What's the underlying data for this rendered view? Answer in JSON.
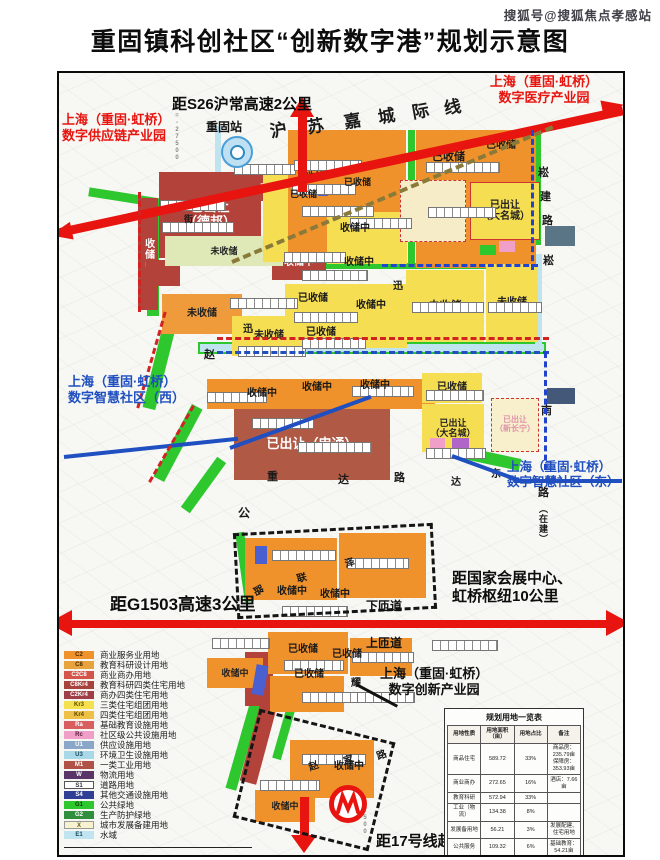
{
  "watermark": "搜狐号@搜狐焦点孝感站",
  "title": "重固镇科创社区“创新数字港”规划示意图",
  "colors": {
    "accent_red": "#e8140f",
    "label_blue": "#1f4fc0",
    "label_red": "#e8140f"
  },
  "callouts": {
    "s26": "距S26沪常高速2公里",
    "medical_1": "上海（重固·虹桥）",
    "medical_2": "数字医疗产业园",
    "supply_1": "上海（重固·虹桥）",
    "supply_2": "数字供应链产业园",
    "west_1": "上海（重固·虹桥）",
    "west_2": "数字智慧社区（西）",
    "east_1": "上海（重固·虹桥）",
    "east_2": "数字智慧社区（东）",
    "innovation_1": "上海（重固·虹桥）",
    "innovation_2": "数字创新产业园",
    "g1503": "距G1503高速3公里",
    "expo_1": "距国家会展中心、",
    "expo_2": "虹桥枢纽10公里",
    "down_ramp": "下匝道",
    "up_ramp": "上匝道",
    "metro17": "距17号线赵巷站1公里",
    "station": "重固站"
  },
  "legend": {
    "items": [
      {
        "code": "C2",
        "label": "商业服务业用地",
        "color": "#f0922b",
        "fg": "#4a2c00"
      },
      {
        "code": "C8",
        "label": "教育科研设计用地",
        "color": "#e8a33c",
        "fg": "#4a2c00"
      },
      {
        "code": "C2C8",
        "label": "商业商办用地",
        "color": "#d4554a",
        "fg": "#ffffff"
      },
      {
        "code": "C8Kr4",
        "label": "教育科研四类住宅用地",
        "color": "#a8423c",
        "fg": "#ffffff"
      },
      {
        "code": "C2Kr4",
        "label": "商办四类住宅用地",
        "color": "#9e3f48",
        "fg": "#ffffff"
      },
      {
        "code": "Kr3",
        "label": "三类住宅组团用地",
        "color": "#f5e04e",
        "fg": "#5a4a00"
      },
      {
        "code": "Kr4",
        "label": "四类住宅组团用地",
        "color": "#eec045",
        "fg": "#5a4a00"
      },
      {
        "code": "Ra",
        "label": "基础教育设施用地",
        "color": "#d95f5f",
        "fg": "#ffffff"
      },
      {
        "code": "Rc",
        "label": "社区级公共设施用地",
        "color": "#f0a0c8",
        "fg": "#5a1a3a"
      },
      {
        "code": "U1",
        "label": "供应设施用地",
        "color": "#8aa6c8",
        "fg": "#ffffff"
      },
      {
        "code": "U3",
        "label": "环境卫生设施用地",
        "color": "#a9d9e8",
        "fg": "#1a4a5a"
      },
      {
        "code": "M1",
        "label": "一类工业用地",
        "color": "#b05248",
        "fg": "#ffffff"
      },
      {
        "code": "W",
        "label": "物流用地",
        "color": "#5a3668",
        "fg": "#ffffff"
      },
      {
        "code": "S1",
        "label": "道路用地",
        "color": "#ffffff",
        "fg": "#333333",
        "border": "1px solid #555"
      },
      {
        "code": "S4",
        "label": "其他交通设施用地",
        "color": "#2f3f96",
        "fg": "#ffffff"
      },
      {
        "code": "G1",
        "label": "公共绿地",
        "color": "#2ec82e",
        "fg": "#063a06"
      },
      {
        "code": "G2",
        "label": "生产防护绿地",
        "color": "#2f8f3c",
        "fg": "#ffffff"
      },
      {
        "code": "X",
        "label": "城市发展备建用地",
        "color": "#f7f2cf",
        "fg": "#6a5a20",
        "border": "1px solid #999"
      },
      {
        "code": "E1",
        "label": "水域",
        "color": "#c0e4f0",
        "fg": "#1a4a5a"
      }
    ]
  },
  "table": {
    "title": "规划用地一览表",
    "headers": [
      "用地性质",
      "用地面积（亩）",
      "用地占比",
      "备注"
    ],
    "rows": [
      [
        "商品住宅",
        "589.72",
        "33%",
        "商品房：235.79亩\n保障房：353.93亩"
      ],
      [
        "商业商办",
        "272.65",
        "16%",
        "酒店：7.66亩"
      ],
      [
        "教育科研",
        "572.94",
        "33%",
        ""
      ],
      [
        "工业（物流）",
        "134.38",
        "8%",
        ""
      ],
      [
        "发展备用地",
        "56.21",
        "3%",
        "发展配建、住宅用地"
      ],
      [
        "公共服务",
        "109.32",
        "6%",
        "基础教育：54.21亩"
      ],
      [
        "合计",
        "1724.6",
        "100%",
        ""
      ]
    ]
  },
  "map": {
    "parcels": [
      {
        "x": 86,
        "y": 197,
        "w": 150,
        "h": 9,
        "bg": "#2ec82e",
        "rot": 9
      },
      {
        "x": 145,
        "y": 206,
        "w": 12,
        "h": 108,
        "bg": "#2ec82e"
      },
      {
        "x": 152,
        "y": 312,
        "w": 13,
        "h": 96,
        "bg": "#2ec82e",
        "rot": 14
      },
      {
        "x": 170,
        "y": 400,
        "w": 12,
        "h": 82,
        "bg": "#2ec82e",
        "rot": 28
      },
      {
        "x": 196,
        "y": 452,
        "w": 11,
        "h": 62,
        "bg": "#2ec82e",
        "rot": 36
      },
      {
        "x": 406,
        "y": 128,
        "w": 7,
        "h": 138,
        "bg": "#2ec82e"
      },
      {
        "x": 287,
        "y": 261,
        "w": 250,
        "h": 6,
        "bg": "#2ec82e"
      },
      {
        "x": 534,
        "y": 128,
        "w": 5,
        "h": 115,
        "bg": "#2ec82e"
      },
      {
        "x": 424,
        "y": 447,
        "w": 95,
        "h": 12,
        "bg": "#2ec82e",
        "rot": 12
      },
      {
        "x": 236,
        "y": 697,
        "w": 11,
        "h": 92,
        "bg": "#2ec82e",
        "rot": 16
      },
      {
        "x": 278,
        "y": 700,
        "w": 9,
        "h": 58,
        "bg": "#2ec82e",
        "rot": 16
      },
      {
        "x": 238,
        "y": 530,
        "w": 9,
        "h": 70,
        "bg": "#2ec82e",
        "rot": -8
      },
      {
        "x": 196,
        "y": 340,
        "w": 348,
        "h": 12,
        "bg": "#bfe3ef",
        "bd": "2px solid #2ec82e",
        "n": "river"
      },
      {
        "x": 533,
        "y": 252,
        "w": 7,
        "h": 92,
        "bg": "#bfe3ef",
        "n": "canal"
      },
      {
        "x": 213,
        "y": 124,
        "w": 6,
        "h": 48,
        "bg": "#bfe3ef",
        "n": "canal"
      },
      {
        "x": 157,
        "y": 170,
        "w": 102,
        "h": 86,
        "bg": "#b2423a",
        "t": "已出让",
        "t2": "（德邦）",
        "fg": "#fff",
        "fs": 13
      },
      {
        "x": 136,
        "y": 196,
        "w": 20,
        "h": 112,
        "bg": "#b2423a",
        "t": "收储中",
        "fg": "#fff",
        "fs": 10,
        "vert": 1
      },
      {
        "x": 250,
        "y": 173,
        "w": 40,
        "h": 26,
        "bg": "#b2423a",
        "t": "已收储",
        "fg": "#fff",
        "fs": 8
      },
      {
        "x": 270,
        "y": 244,
        "w": 54,
        "h": 34,
        "bg": "#b2423a",
        "t": "收储中",
        "fg": "#fff",
        "fs": 10
      },
      {
        "x": 144,
        "y": 258,
        "w": 34,
        "h": 26,
        "bg": "#b2423a"
      },
      {
        "x": 232,
        "y": 406,
        "w": 156,
        "h": 72,
        "bg": "#b05a45",
        "t": "已出让（申通）",
        "fg": "#fff",
        "fs": 13
      },
      {
        "x": 243,
        "y": 650,
        "w": 28,
        "h": 54,
        "bg": "#b2423a"
      },
      {
        "x": 248,
        "y": 700,
        "w": 17,
        "h": 82,
        "bg": "#b2423a",
        "rot": 15
      },
      {
        "x": 455,
        "y": 379,
        "w": 16,
        "h": 13,
        "bg": "#cc4040"
      },
      {
        "x": 286,
        "y": 128,
        "w": 118,
        "h": 132,
        "bg": "#f0922b"
      },
      {
        "x": 414,
        "y": 128,
        "w": 120,
        "h": 138,
        "bg": "#f0922b"
      },
      {
        "x": 163,
        "y": 234,
        "w": 118,
        "h": 30,
        "bg": "#dfe9b8",
        "t": "未收储",
        "fs": 9
      },
      {
        "x": 160,
        "y": 292,
        "w": 80,
        "h": 40,
        "bg": "#ef9b3c",
        "t": "未收储",
        "fs": 10
      },
      {
        "x": 205,
        "y": 377,
        "w": 228,
        "h": 30,
        "bg": "#f0922b"
      },
      {
        "x": 243,
        "y": 536,
        "w": 92,
        "h": 62,
        "bg": "#f0922b"
      },
      {
        "x": 337,
        "y": 531,
        "w": 87,
        "h": 65,
        "bg": "#f0922b"
      },
      {
        "x": 266,
        "y": 630,
        "w": 80,
        "h": 42,
        "bg": "#f0922b"
      },
      {
        "x": 348,
        "y": 636,
        "w": 62,
        "h": 38,
        "bg": "#f0922b"
      },
      {
        "x": 268,
        "y": 674,
        "w": 74,
        "h": 36,
        "bg": "#f0922b"
      },
      {
        "x": 205,
        "y": 656,
        "w": 56,
        "h": 30,
        "bg": "#f0922b",
        "t": "收储中",
        "fs": 9
      },
      {
        "x": 288,
        "y": 738,
        "w": 84,
        "h": 58,
        "bg": "#f0922b"
      },
      {
        "x": 253,
        "y": 788,
        "w": 60,
        "h": 32,
        "bg": "#f0922b",
        "t": "收储中",
        "fs": 9
      },
      {
        "x": 261,
        "y": 168,
        "w": 25,
        "h": 92,
        "bg": "#f5de52"
      },
      {
        "x": 325,
        "y": 210,
        "w": 80,
        "h": 52,
        "bg": "#f5de52"
      },
      {
        "x": 283,
        "y": 282,
        "w": 122,
        "h": 64,
        "bg": "#f5de52"
      },
      {
        "x": 230,
        "y": 314,
        "w": 74,
        "h": 40,
        "bg": "#f5de52",
        "t": "未收储",
        "fs": 10
      },
      {
        "x": 404,
        "y": 268,
        "w": 78,
        "h": 72,
        "bg": "#f5de52",
        "t": "未收储",
        "fs": 11
      },
      {
        "x": 484,
        "y": 262,
        "w": 52,
        "h": 78,
        "bg": "#f5de52",
        "t": "未收储",
        "fs": 10
      },
      {
        "x": 468,
        "y": 180,
        "w": 70,
        "h": 58,
        "bg": "#f5de52",
        "t": "已出让",
        "t2": "（大名城）",
        "fs": 10,
        "bd": "1px solid #cc3333"
      },
      {
        "x": 420,
        "y": 371,
        "w": 60,
        "h": 30,
        "bg": "#f5de52",
        "t": "已收储",
        "fs": 10
      },
      {
        "x": 420,
        "y": 402,
        "w": 62,
        "h": 48,
        "bg": "#f5de52",
        "t": "已出让",
        "t2": "（大名城）",
        "fs": 9
      },
      {
        "x": 398,
        "y": 178,
        "w": 66,
        "h": 62,
        "bg": "#f6edc8",
        "bd": "1px dashed #cc3333"
      },
      {
        "x": 489,
        "y": 396,
        "w": 48,
        "h": 54,
        "bg": "#f8f0cc",
        "t": "已出让",
        "t2": "（新长宁）",
        "fg": "#df93ab",
        "fs": 8,
        "bd": "1px dashed #cc3333"
      },
      {
        "x": 543,
        "y": 224,
        "w": 30,
        "h": 20,
        "bg": "#5a7585"
      },
      {
        "x": 545,
        "y": 386,
        "w": 28,
        "h": 16,
        "bg": "#44597a"
      },
      {
        "x": 497,
        "y": 239,
        "w": 16,
        "h": 11,
        "bg": "#f0a0c8"
      },
      {
        "x": 428,
        "y": 436,
        "w": 15,
        "h": 11,
        "bg": "#f0a0c8"
      },
      {
        "x": 450,
        "y": 436,
        "w": 17,
        "h": 11,
        "bg": "#b065c8"
      },
      {
        "x": 253,
        "y": 544,
        "w": 12,
        "h": 18,
        "bg": "#4a5fd0"
      },
      {
        "x": 252,
        "y": 663,
        "w": 12,
        "h": 30,
        "bg": "#4a5fd0",
        "rot": 10
      },
      {
        "x": 316,
        "y": 182,
        "w": 10,
        "h": 12,
        "bg": "#4a5fd0"
      },
      {
        "x": 478,
        "y": 243,
        "w": 16,
        "h": 10,
        "bg": "#2ec82e"
      }
    ],
    "labels": [
      {
        "t": "沪",
        "x": 268,
        "y": 120,
        "fs": 17,
        "rot": -10
      },
      {
        "t": "苏",
        "x": 305,
        "y": 116,
        "fs": 17,
        "rot": -10
      },
      {
        "t": "嘉",
        "x": 342,
        "y": 111,
        "fs": 17,
        "rot": -10
      },
      {
        "t": "城",
        "x": 376,
        "y": 106,
        "fs": 17,
        "rot": -10
      },
      {
        "t": "际",
        "x": 410,
        "y": 101,
        "fs": 17,
        "rot": -10
      },
      {
        "t": "线",
        "x": 442,
        "y": 97,
        "fs": 17,
        "rot": -10
      },
      {
        "t": "已收储",
        "x": 295,
        "y": 170,
        "fs": 9
      },
      {
        "t": "已收储",
        "x": 288,
        "y": 188,
        "fs": 9
      },
      {
        "t": "已收储",
        "x": 342,
        "y": 176,
        "fs": 9
      },
      {
        "t": "已收储",
        "x": 430,
        "y": 150,
        "fs": 11
      },
      {
        "t": "已收储",
        "x": 484,
        "y": 139,
        "fs": 10
      },
      {
        "t": "收储中",
        "x": 338,
        "y": 222,
        "fs": 10
      },
      {
        "t": "收储中",
        "x": 342,
        "y": 256,
        "fs": 10
      },
      {
        "t": "已收储",
        "x": 296,
        "y": 292,
        "fs": 10
      },
      {
        "t": "已收储",
        "x": 304,
        "y": 326,
        "fs": 10
      },
      {
        "t": "收储中",
        "x": 354,
        "y": 299,
        "fs": 10
      },
      {
        "t": "收储中",
        "x": 245,
        "y": 387,
        "fs": 10
      },
      {
        "t": "收储中",
        "x": 300,
        "y": 381,
        "fs": 10
      },
      {
        "t": "收储中",
        "x": 358,
        "y": 379,
        "fs": 10
      },
      {
        "t": "收储中",
        "x": 275,
        "y": 585,
        "fs": 10
      },
      {
        "t": "收储中",
        "x": 318,
        "y": 588,
        "fs": 10
      },
      {
        "t": "已收储",
        "x": 286,
        "y": 643,
        "fs": 10
      },
      {
        "t": "已收储",
        "x": 330,
        "y": 648,
        "fs": 10
      },
      {
        "t": "已收储",
        "x": 292,
        "y": 668,
        "fs": 10
      },
      {
        "t": "收储中",
        "x": 332,
        "y": 760,
        "fs": 10
      },
      {
        "t": "崧",
        "x": 536,
        "y": 166,
        "fs": 11
      },
      {
        "t": "建",
        "x": 538,
        "y": 190,
        "fs": 11
      },
      {
        "t": "路",
        "x": 540,
        "y": 214,
        "fs": 11
      },
      {
        "t": "崧",
        "x": 541,
        "y": 254,
        "fs": 11
      },
      {
        "t": "南",
        "x": 539,
        "y": 404,
        "fs": 11
      },
      {
        "t": "路",
        "x": 536,
        "y": 486,
        "fs": 11
      },
      {
        "t": "（在建）",
        "x": 536,
        "y": 502,
        "fs": 9,
        "vert": 1
      },
      {
        "t": "赵",
        "x": 202,
        "y": 348,
        "fs": 11
      },
      {
        "t": "迅",
        "x": 241,
        "y": 323,
        "fs": 10
      },
      {
        "t": "迅",
        "x": 391,
        "y": 280,
        "fs": 10
      },
      {
        "t": "公",
        "x": 236,
        "y": 505,
        "fs": 12
      },
      {
        "t": "重",
        "x": 265,
        "y": 470,
        "fs": 11
      },
      {
        "t": "达",
        "x": 336,
        "y": 473,
        "fs": 11
      },
      {
        "t": "路",
        "x": 392,
        "y": 471,
        "fs": 11
      },
      {
        "t": "东",
        "x": 489,
        "y": 468,
        "fs": 10
      },
      {
        "t": "达",
        "x": 449,
        "y": 476,
        "fs": 10
      },
      {
        "t": "联",
        "x": 295,
        "y": 572,
        "fs": 10,
        "rot": -15
      },
      {
        "t": "泽",
        "x": 343,
        "y": 557,
        "fs": 10,
        "rot": -15
      },
      {
        "t": "路",
        "x": 250,
        "y": 584,
        "fs": 10,
        "rot": 60
      },
      {
        "t": "耀",
        "x": 349,
        "y": 677,
        "fs": 10
      },
      {
        "t": "赵",
        "x": 307,
        "y": 760,
        "fs": 10,
        "rot": -20
      },
      {
        "t": "家",
        "x": 342,
        "y": 754,
        "fs": 10,
        "rot": -20
      },
      {
        "t": "路",
        "x": 375,
        "y": 749,
        "fs": 10,
        "rot": -20
      },
      {
        "t": "街",
        "x": 182,
        "y": 213,
        "fs": 9
      },
      {
        "t": "Y=-27500",
        "x": 172,
        "y": 104,
        "fs": 6,
        "c": "#888",
        "vert": 1
      },
      {
        "t": "-27500",
        "x": 360,
        "y": 792,
        "fs": 6,
        "c": "#888",
        "vert": 1
      }
    ],
    "strips": [
      [
        158,
        198,
        64
      ],
      [
        160,
        220,
        70
      ],
      [
        232,
        162,
        60
      ],
      [
        292,
        158,
        66
      ],
      [
        290,
        182,
        62
      ],
      [
        300,
        204,
        70
      ],
      [
        424,
        160,
        72
      ],
      [
        426,
        205,
        66
      ],
      [
        348,
        216,
        60
      ],
      [
        282,
        250,
        60
      ],
      [
        300,
        268,
        64
      ],
      [
        228,
        296,
        66
      ],
      [
        292,
        310,
        62
      ],
      [
        236,
        344,
        66
      ],
      [
        300,
        336,
        62
      ],
      [
        410,
        300,
        70
      ],
      [
        486,
        300,
        52
      ],
      [
        250,
        416,
        60
      ],
      [
        296,
        440,
        72
      ],
      [
        424,
        388,
        56
      ],
      [
        424,
        446,
        58
      ],
      [
        350,
        384,
        60
      ],
      [
        205,
        390,
        58
      ],
      [
        270,
        548,
        62
      ],
      [
        345,
        556,
        60
      ],
      [
        280,
        604,
        64
      ],
      [
        350,
        650,
        60
      ],
      [
        282,
        658,
        58
      ],
      [
        210,
        636,
        56
      ],
      [
        300,
        690,
        62
      ],
      [
        355,
        690,
        56
      ],
      [
        300,
        752,
        62
      ],
      [
        258,
        778,
        58
      ],
      [
        430,
        638,
        64
      ]
    ]
  }
}
